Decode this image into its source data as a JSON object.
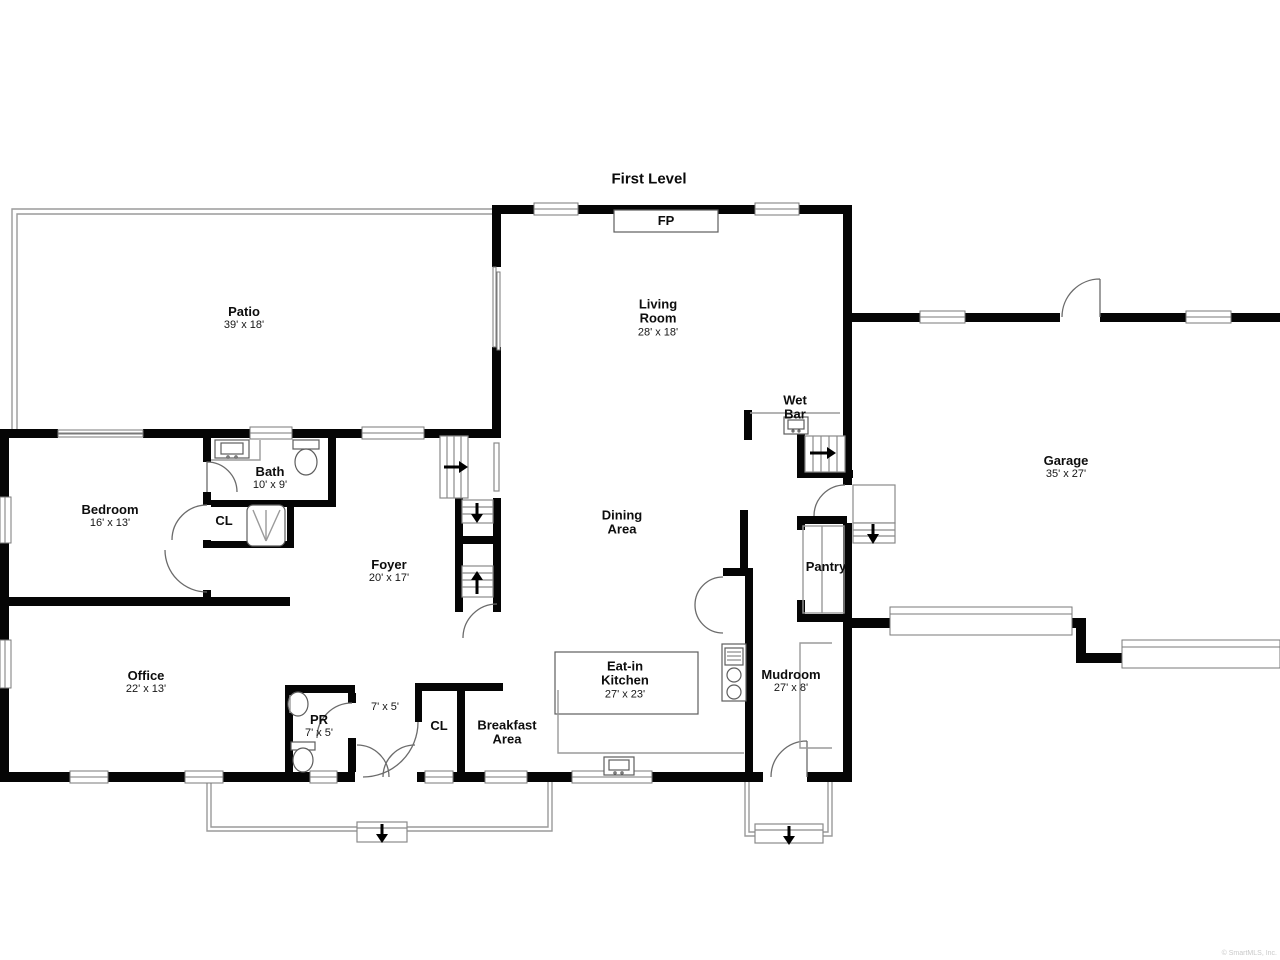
{
  "title": "First Level",
  "watermark": "© SmartMLS, Inc.",
  "rooms": {
    "patio": {
      "name": "Patio",
      "dims": "39' x 18'"
    },
    "living_room": {
      "name": "Living Room",
      "dims": "28' x 18'"
    },
    "fireplace": {
      "name": "FP"
    },
    "wet_bar": {
      "name": "Wet Bar"
    },
    "garage": {
      "name": "Garage",
      "dims": "35' x 27'"
    },
    "bedroom": {
      "name": "Bedroom",
      "dims": "16' x 13'"
    },
    "bath": {
      "name": "Bath",
      "dims": "10' x 9'"
    },
    "bath_closet": {
      "name": "CL"
    },
    "foyer": {
      "name": "Foyer",
      "dims": "20' x 17'"
    },
    "dining_area": {
      "name": "Dining Area"
    },
    "pantry": {
      "name": "Pantry"
    },
    "office": {
      "name": "Office",
      "dims": "22' x 13'"
    },
    "powder_room": {
      "name": "PR",
      "dims": "7' x 5'"
    },
    "hall_closet": {
      "dims": "7' x 5'"
    },
    "hall_closet_cl": {
      "name": "CL"
    },
    "breakfast_area": {
      "name": "Breakfast Area"
    },
    "kitchen": {
      "name": "Eat-in Kitchen",
      "dims": "27' x 23'"
    },
    "mudroom": {
      "name": "Mudroom",
      "dims": "27' x 8'"
    }
  }
}
